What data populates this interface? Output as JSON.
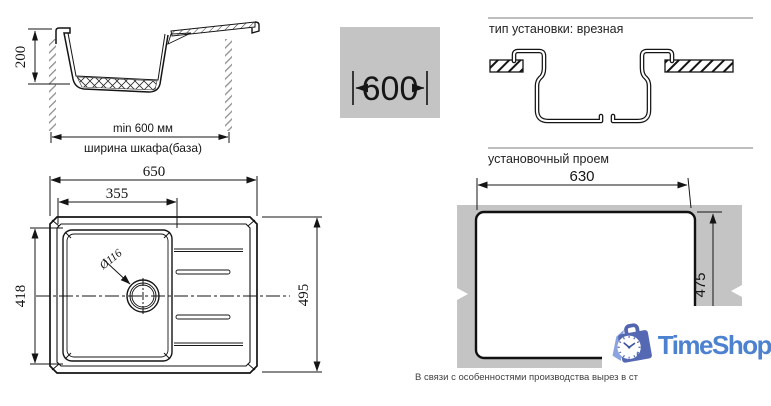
{
  "side_view": {
    "depth_label": "200",
    "min_width_label": "min 600 мм",
    "cabinet_width_label": "ширина шкафа(база)"
  },
  "cabinet_box": {
    "width_label": "600"
  },
  "install_type": {
    "title": "тип установки: врезная"
  },
  "opening": {
    "title": "установочный проем",
    "width_label": "630",
    "height_label": "475"
  },
  "top_view": {
    "overall_width": "650",
    "bowl_width": "355",
    "bowl_height": "418",
    "overall_height": "495",
    "drain_diameter": "Ø116"
  },
  "footnote": "В связи с особенностями производства вырез в ст",
  "logo": {
    "name": "TimeShop"
  },
  "colors": {
    "line": "#141414",
    "countertop_gray": "#c4c4c4",
    "logo_blue": "#4d82d0",
    "logo_bag_blue": "#5468b4",
    "logo_light_blue": "#8ba3de"
  }
}
